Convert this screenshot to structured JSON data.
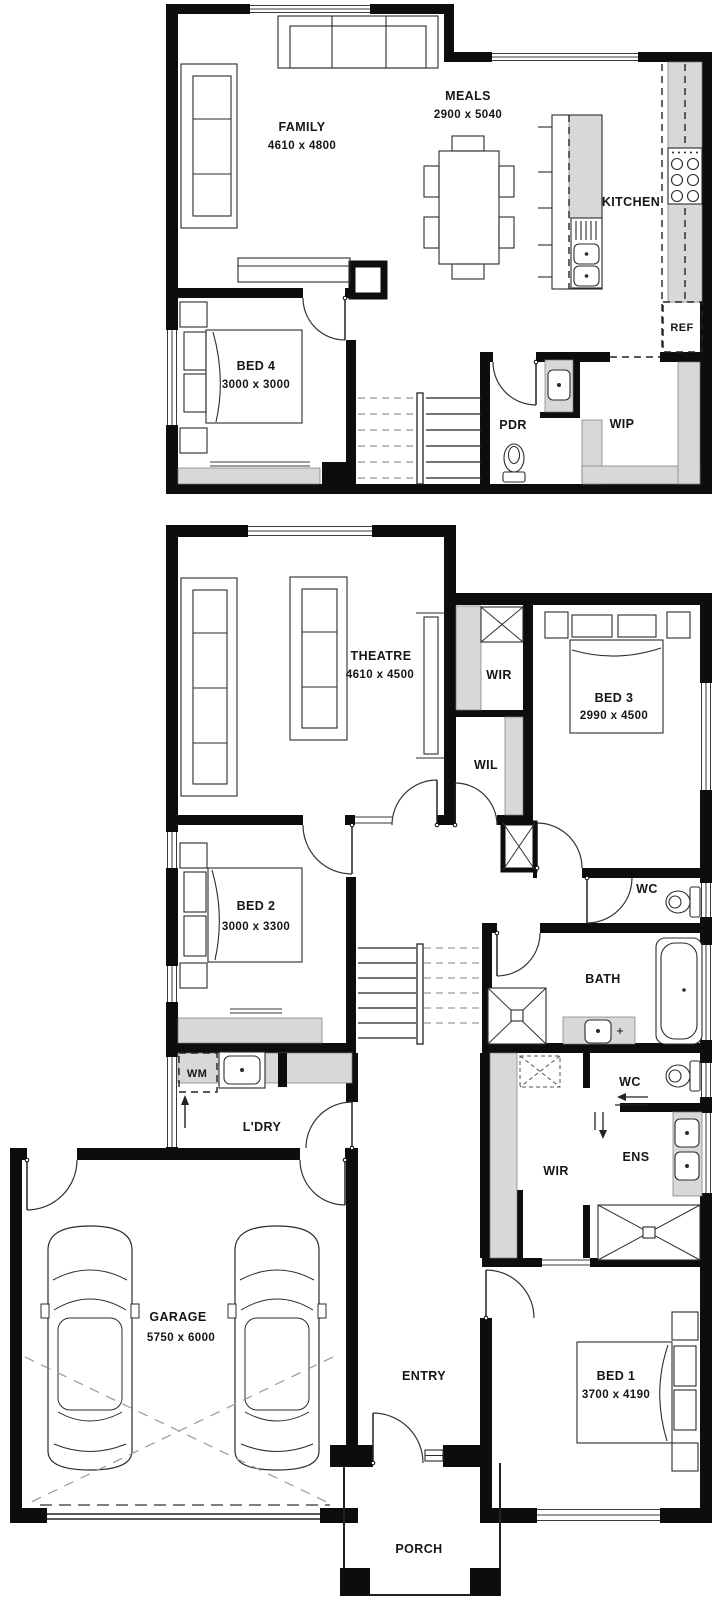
{
  "colors": {
    "wall": "#0d0d0d",
    "shelf_gray": "#d8d8d8",
    "background": "#ffffff"
  },
  "upper_floor": {
    "family": {
      "name": "FAMILY",
      "dim": "4610 x 4800"
    },
    "meals": {
      "name": "MEALS",
      "dim": "2900 x 5040"
    },
    "kitchen": {
      "name": "KITCHEN"
    },
    "bed4": {
      "name": "BED 4",
      "dim": "3000 x 3000"
    },
    "pdr": {
      "name": "PDR"
    },
    "wip": {
      "name": "WIP"
    },
    "fridge": {
      "name": "REF"
    }
  },
  "ground_floor": {
    "theatre": {
      "name": "THEATRE",
      "dim": "4610 x 4500"
    },
    "wir_hall": {
      "name": "WIR"
    },
    "bed3": {
      "name": "BED 3",
      "dim": "2990 x 4500"
    },
    "wil": {
      "name": "WIL"
    },
    "bed2": {
      "name": "BED 2",
      "dim": "3000 x 3300"
    },
    "wc_main": {
      "name": "WC"
    },
    "bath": {
      "name": "BATH"
    },
    "washing_machine": {
      "name": "WM"
    },
    "laundry": {
      "name": "L'DRY"
    },
    "wc_ens": {
      "name": "WC"
    },
    "ens": {
      "name": "ENS"
    },
    "wir_master": {
      "name": "WIR"
    },
    "garage": {
      "name": "GARAGE",
      "dim": "5750 x 6000"
    },
    "entry": {
      "name": "ENTRY"
    },
    "bed1": {
      "name": "BED 1",
      "dim": "3700 x 4190"
    },
    "porch": {
      "name": "PORCH"
    }
  }
}
